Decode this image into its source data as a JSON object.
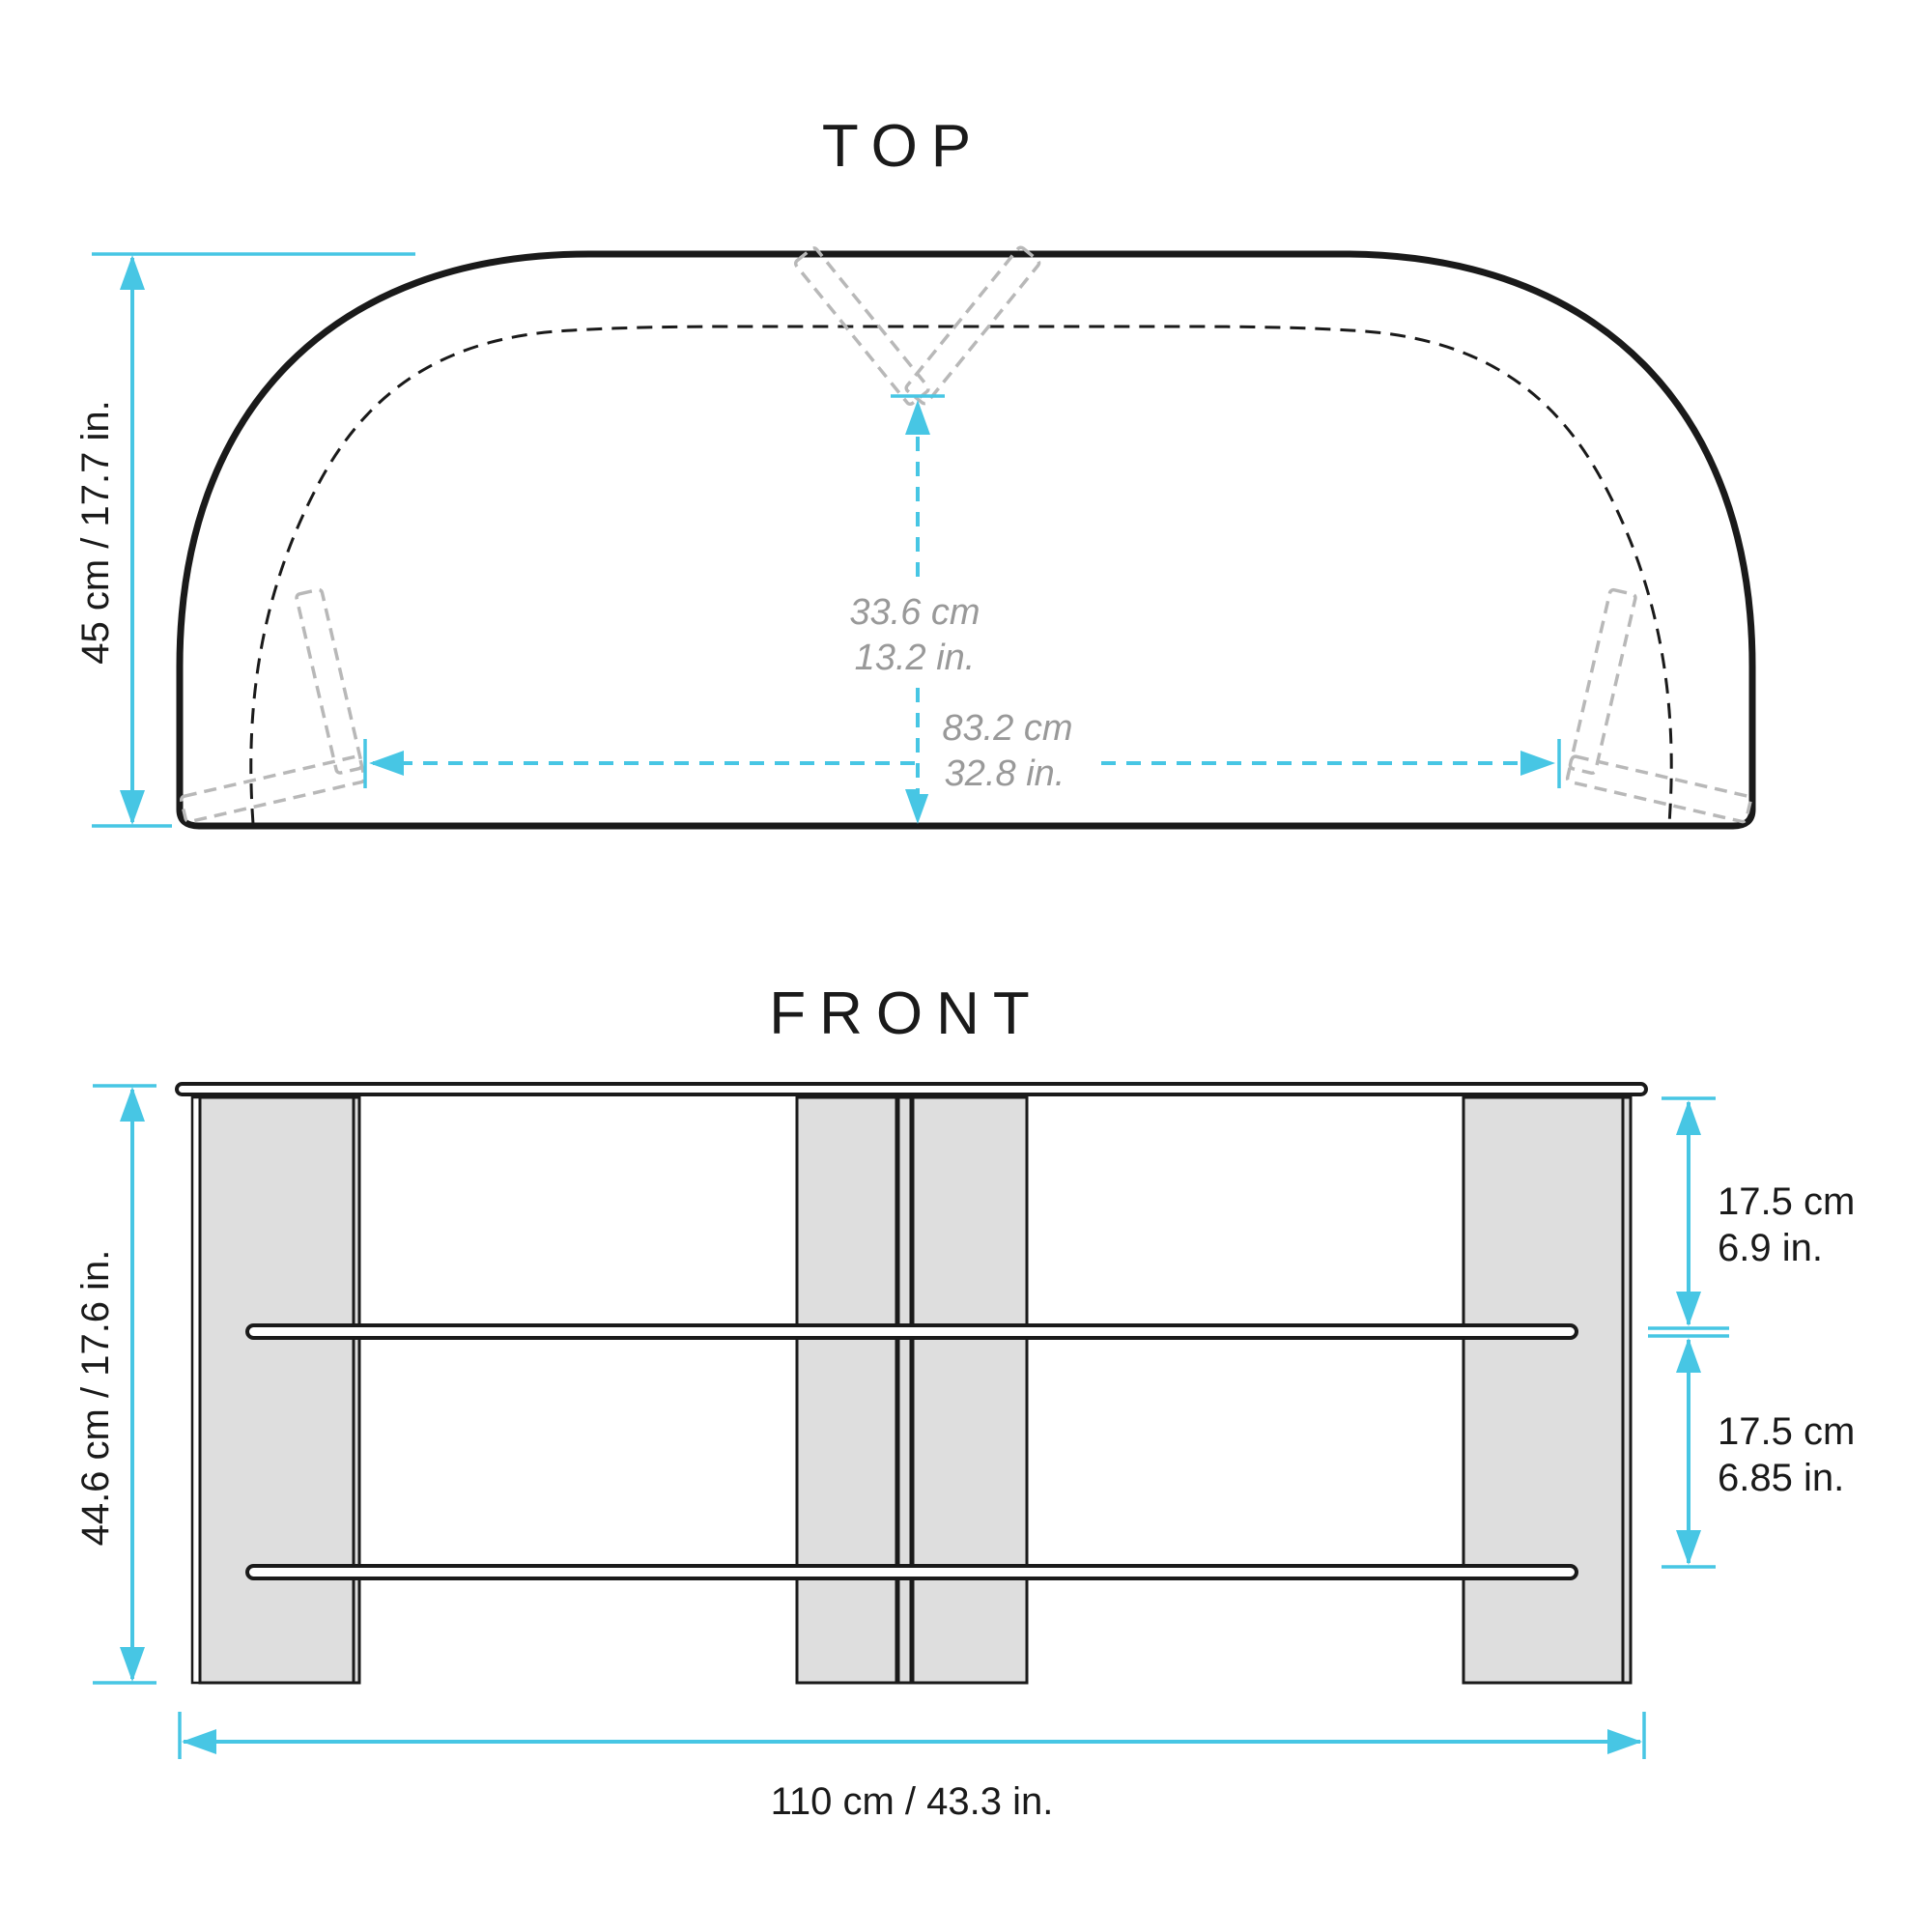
{
  "colors": {
    "accent_cyan": "#47c6e4",
    "line_black": "#1a1a1a",
    "leg_fill_gray": "#dedede",
    "bracket_dash_gray": "#b8b8b8",
    "dim_gray_text": "#999999"
  },
  "top_view": {
    "title": "TOP",
    "depth_dim": "45 cm / 17.7 in.",
    "inner_depth_cm": "33.6 cm",
    "inner_depth_in": "13.2 in.",
    "inner_width_cm": "83.2 cm",
    "inner_width_in": "32.8 in."
  },
  "front_view": {
    "title": "FRONT",
    "height_dim": "44.6 cm / 17.6 in.",
    "upper_shelf_gap_cm": "17.5 cm",
    "upper_shelf_gap_in": "6.9 in.",
    "lower_shelf_gap_cm": "17.5 cm",
    "lower_shelf_gap_in": "6.85 in.",
    "width_dim": "110 cm / 43.3 in."
  }
}
